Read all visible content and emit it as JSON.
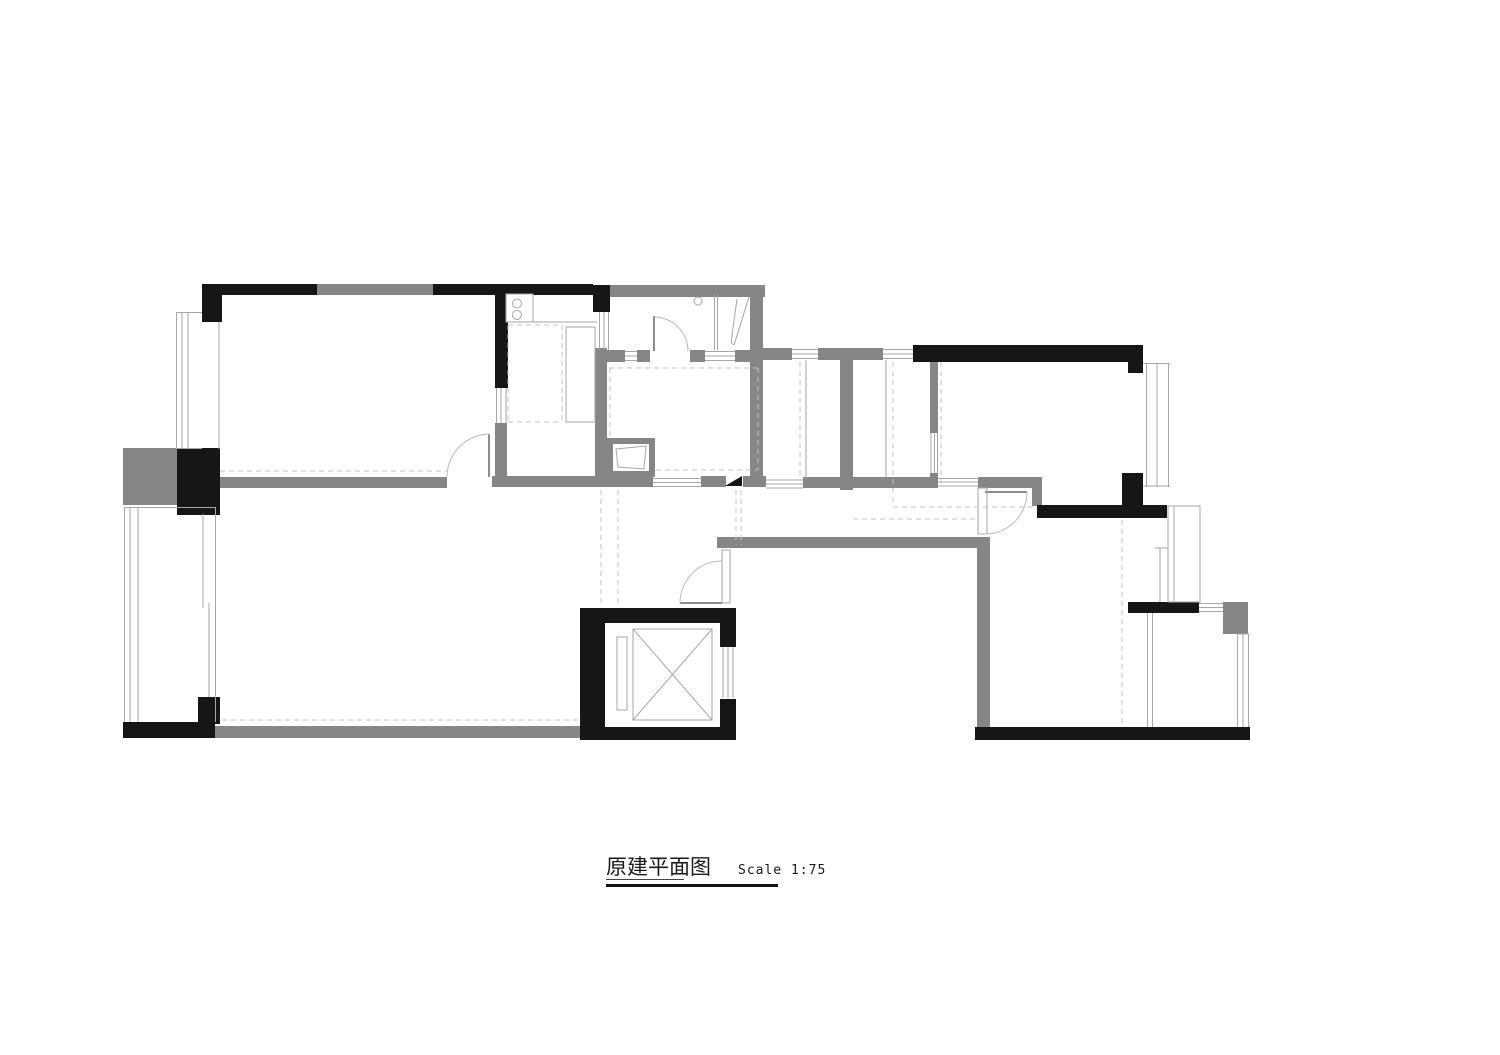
{
  "title": {
    "main": "原建平面图",
    "scale": "Scale 1:75"
  },
  "colors": {
    "wall_black": "#161616",
    "wall_gray": "#868686",
    "thin": "#a6a6a6",
    "mid": "#8c8c8c",
    "dash": "#c3c3c3",
    "arc": "#b9b9b9",
    "white": "#ffffff"
  },
  "plan": {
    "gray_rects": [
      [
        317,
        284,
        116,
        11,
        "wall-top-window-segment"
      ],
      [
        605,
        285,
        160,
        12,
        "bath-north-wall"
      ],
      [
        750,
        297,
        13,
        180,
        "bath-east-wall"
      ],
      [
        220,
        477,
        227,
        11,
        "bedroom1-south-wall"
      ],
      [
        492,
        476,
        161,
        11,
        "kitchen-south-wall"
      ],
      [
        495,
        423,
        12,
        53,
        "kitchen-west-gray"
      ],
      [
        595,
        348,
        12,
        129,
        "kitchen-east-wall"
      ],
      [
        605,
        350,
        20,
        12,
        "bath-divider-a"
      ],
      [
        637,
        350,
        13,
        12,
        "bath-divider-b"
      ],
      [
        690,
        350,
        15,
        12,
        "bath-divider-c"
      ],
      [
        735,
        350,
        28,
        12,
        "bath-divider-d"
      ],
      [
        763,
        348,
        29,
        12,
        "shaft-north-a"
      ],
      [
        818,
        348,
        65,
        12,
        "shaft-north-b"
      ],
      [
        840,
        360,
        13,
        130,
        "shaft-divider-wall"
      ],
      [
        930,
        362,
        8,
        71,
        "bedroom2-west-wall"
      ],
      [
        930,
        473,
        8,
        15,
        "bedroom2-west-foot"
      ],
      [
        701,
        476,
        25,
        11,
        "bath-south-b"
      ],
      [
        743,
        476,
        23,
        11,
        "bath-south-c"
      ],
      [
        803,
        477,
        135,
        11,
        "shaft-south-wall"
      ],
      [
        978,
        477,
        64,
        11,
        "hall-north-wall"
      ],
      [
        1032,
        477,
        10,
        29,
        "hall-jamb-wall"
      ],
      [
        717,
        537,
        273,
        11,
        "hall-south-wall"
      ],
      [
        977,
        548,
        13,
        179,
        "bedroom3-west-wall"
      ],
      [
        215,
        726,
        365,
        12,
        "living-south-wall"
      ],
      [
        123,
        448,
        54,
        57,
        "west-gray-block"
      ],
      [
        1223,
        602,
        25,
        32,
        "balcony2-gray-block"
      ],
      [
        607,
        438,
        48,
        6,
        "basin-box-top"
      ],
      [
        607,
        438,
        6,
        39,
        "basin-box-left"
      ],
      [
        649,
        438,
        6,
        39,
        "basin-box-right"
      ],
      [
        607,
        471,
        48,
        6,
        "basin-box-bottom"
      ]
    ],
    "black_rects": [
      [
        202,
        284,
        20,
        38,
        "column-topleft"
      ],
      [
        202,
        284,
        115,
        11,
        "top-wall-west"
      ],
      [
        433,
        284,
        160,
        11,
        "top-wall-east"
      ],
      [
        495,
        295,
        13,
        93,
        "kitchen-west-wall"
      ],
      [
        593,
        285,
        17,
        27,
        "column-bath-north"
      ],
      [
        913,
        345,
        230,
        17,
        "bedroom2-north-wall"
      ],
      [
        1128,
        345,
        15,
        28,
        "column-northeast"
      ],
      [
        1122,
        473,
        21,
        32,
        "column-bedroom2-se"
      ],
      [
        1037,
        505,
        130,
        13,
        "bedroom2-south-wall"
      ],
      [
        177,
        448,
        43,
        67,
        "column-west-mid"
      ],
      [
        198,
        697,
        22,
        27,
        "corner-stub-southwest"
      ],
      [
        123,
        722,
        92,
        16,
        "southwest-wall"
      ],
      [
        1128,
        602,
        71,
        11,
        "balcony2-north-wall"
      ],
      [
        975,
        727,
        275,
        13,
        "southeast-wall"
      ],
      [
        580,
        608,
        156,
        132,
        "elevator-shaft-frame"
      ]
    ],
    "white_rects": [
      [
        605,
        623,
        115,
        104,
        "elevator-cab-interior"
      ],
      [
        718,
        647,
        18,
        52,
        "elevator-door-opening"
      ],
      [
        613,
        444,
        36,
        27,
        "basin-box-interior"
      ]
    ],
    "outline_rects": [
      [
        633,
        629,
        79,
        91,
        "none",
        "elevator-car-box"
      ],
      [
        617,
        637,
        10,
        73,
        "none",
        "elevator-counterweight"
      ],
      [
        978,
        488,
        9,
        46,
        "#ffffff",
        "bedroom3-door-frame"
      ],
      [
        722,
        550,
        8,
        53,
        "#ffffff",
        "entry-door-frame"
      ],
      [
        506,
        294,
        27,
        28,
        "#ffffff",
        "stove-unit"
      ],
      [
        566,
        327,
        29,
        95,
        "#ffffff",
        "kitchen-cabinet"
      ],
      [
        1168,
        506,
        32,
        96,
        "#ffffff",
        "ac-platform"
      ]
    ],
    "thin_lines": [
      [
        653,
        478.5,
        701,
        478.5,
        "window-bath-s-1"
      ],
      [
        653,
        482.5,
        701,
        482.5,
        "window-bath-s-2"
      ],
      [
        653,
        486.5,
        701,
        486.5,
        "window-bath-s-3"
      ],
      [
        766,
        480,
        803,
        480,
        "window-shaft-s-1"
      ],
      [
        766,
        484,
        803,
        484,
        "window-shaft-s-2"
      ],
      [
        766,
        488,
        803,
        488,
        "window-shaft-s-3"
      ],
      [
        938,
        478.5,
        978,
        478.5,
        "opening-bedroom2-1"
      ],
      [
        938,
        482,
        978,
        482,
        "opening-bedroom2-2"
      ],
      [
        938,
        486,
        978,
        486,
        "opening-bedroom2-3"
      ],
      [
        792,
        349.5,
        818,
        349.5,
        "window-shaft-n1-1"
      ],
      [
        792,
        354,
        818,
        354,
        "window-shaft-n1-2"
      ],
      [
        792,
        358.5,
        818,
        358.5,
        "window-shaft-n1-3"
      ],
      [
        883,
        349.5,
        913,
        349.5,
        "window-shaft-n2-1"
      ],
      [
        883,
        354,
        913,
        354,
        "window-shaft-n2-2"
      ],
      [
        883,
        358.5,
        913,
        358.5,
        "window-shaft-n2-3"
      ],
      [
        625,
        351.5,
        637,
        351.5,
        "window-bathdiv-1"
      ],
      [
        625,
        356,
        637,
        356,
        "window-bathdiv-2"
      ],
      [
        625,
        360.5,
        637,
        360.5,
        "window-bathdiv-3"
      ],
      [
        705,
        351.5,
        735,
        351.5,
        "window-bathdiv-4"
      ],
      [
        705,
        356,
        735,
        356,
        "window-bathdiv-5"
      ],
      [
        705,
        360.5,
        735,
        360.5,
        "window-bathdiv-6"
      ],
      [
        496.5,
        388,
        496.5,
        423,
        "window-kitchen-w-1"
      ],
      [
        501,
        388,
        501,
        423,
        "window-kitchen-w-2"
      ],
      [
        506,
        388,
        506,
        423,
        "window-kitchen-w-3"
      ],
      [
        599.5,
        312,
        599.5,
        350,
        "window-bath-w-1"
      ],
      [
        604,
        312,
        604,
        350,
        "window-bath-w-2"
      ],
      [
        608.5,
        312,
        608.5,
        350,
        "window-bath-w-3"
      ],
      [
        931,
        433,
        931,
        473,
        "window-bedroom2-w-1"
      ],
      [
        934.5,
        433,
        934.5,
        473,
        "window-bedroom2-w-2"
      ],
      [
        937.5,
        433,
        937.5,
        473,
        "window-bedroom2-w-3"
      ],
      [
        176.5,
        312,
        176.5,
        449,
        "baywindow-w-1"
      ],
      [
        182,
        312,
        182,
        449,
        "baywindow-w-2"
      ],
      [
        188,
        312,
        188,
        449,
        "baywindow-w-3"
      ],
      [
        176,
        312.5,
        202,
        312.5,
        "baywindow-w-top"
      ],
      [
        176,
        448.5,
        202,
        448.5,
        "baywindow-w-bottom"
      ],
      [
        219,
        322,
        219,
        449,
        "bedroom1-west-face"
      ],
      [
        1146.5,
        363,
        1146.5,
        487,
        "baywindow-e-1"
      ],
      [
        1157,
        363,
        1157,
        487,
        "baywindow-e-2"
      ],
      [
        1168.5,
        363,
        1168.5,
        487,
        "baywindow-e-3"
      ],
      [
        1143,
        363.5,
        1170,
        363.5,
        "baywindow-e-top"
      ],
      [
        1143,
        486,
        1170,
        486,
        "baywindow-e-bottom"
      ],
      [
        124.5,
        507,
        124.5,
        722,
        "balcony1-wall-1"
      ],
      [
        130,
        507,
        130,
        722,
        "balcony1-wall-2"
      ],
      [
        138,
        507,
        138,
        722,
        "balcony1-wall-3"
      ],
      [
        124,
        507.5,
        215,
        507.5,
        "balcony1-top"
      ],
      [
        215.5,
        507,
        215.5,
        722,
        "balcony1-inner-face"
      ],
      [
        203,
        514,
        203,
        608,
        "balcony1-slider-a"
      ],
      [
        209,
        603,
        209,
        697,
        "balcony1-slider-b"
      ],
      [
        1147.5,
        613,
        1147.5,
        727,
        "balcony2-slider-a"
      ],
      [
        1152.5,
        613,
        1152.5,
        727,
        "balcony2-slider-b"
      ],
      [
        1199,
        603.5,
        1223,
        603.5,
        "balcony2-window-n-1"
      ],
      [
        1199,
        607.5,
        1223,
        607.5,
        "balcony2-window-n-2"
      ],
      [
        1199,
        611.5,
        1223,
        611.5,
        "balcony2-window-n-3"
      ],
      [
        1237.5,
        634,
        1237.5,
        727,
        "balcony2-window-e-1"
      ],
      [
        1243,
        634,
        1243,
        727,
        "balcony2-window-e-2"
      ],
      [
        1248.5,
        634,
        1248.5,
        727,
        "balcony2-window-e-3"
      ],
      [
        1237,
        634,
        1249,
        634,
        "balcony2-window-e-top"
      ],
      [
        723,
        647,
        723,
        698,
        "elevator-door-1"
      ],
      [
        728,
        647,
        728,
        698,
        "elevator-door-2"
      ],
      [
        733,
        647,
        733,
        698,
        "elevator-door-3"
      ],
      [
        633,
        629,
        712,
        720,
        "elevator-x-diag-1"
      ],
      [
        633,
        720,
        712,
        629,
        "elevator-x-diag-2"
      ],
      [
        806,
        360,
        806,
        479,
        "shaft1-glass-line"
      ],
      [
        886,
        360,
        886,
        477,
        "shaft2-glass-line"
      ],
      [
        1174,
        506,
        1174,
        602,
        "ac-platform-inner"
      ],
      [
        1160,
        548,
        1160,
        602,
        "ac-platform-side"
      ],
      [
        1155,
        548,
        1168,
        548,
        "ac-platform-side-top"
      ],
      [
        737,
        299,
        731,
        343,
        "shower-screen-1"
      ],
      [
        749,
        297,
        734,
        345,
        "shower-screen-2"
      ],
      [
        731,
        343,
        734,
        345,
        "shower-screen-base"
      ],
      [
        714.5,
        295,
        714.5,
        350,
        "bath-partition-1"
      ],
      [
        717.5,
        295,
        717.5,
        350,
        "bath-partition-2"
      ],
      [
        508,
        322,
        597,
        322,
        "kitchen-counter-edge"
      ]
    ],
    "mid_lines": [
      [
        489,
        434,
        489,
        477,
        "door-leaf-bedroom1"
      ],
      [
        654,
        316,
        654,
        351,
        "door-leaf-bath"
      ],
      [
        985,
        492,
        1027,
        492,
        "door-leaf-bedroom3"
      ],
      [
        680,
        603,
        722,
        603,
        "door-leaf-entry"
      ]
    ],
    "dashed_lines": [
      [
        220,
        471,
        447,
        471,
        "curtain-bedroom1"
      ],
      [
        222,
        720,
        578,
        720,
        "curtain-living"
      ],
      [
        609,
        368,
        758,
        368,
        "bath-ceiling-top"
      ],
      [
        610,
        368,
        610,
        440,
        "bath-ceiling-left"
      ],
      [
        758,
        368,
        758,
        470,
        "bath-ceiling-right"
      ],
      [
        656,
        470,
        758,
        470,
        "bath-ceiling-bottom"
      ],
      [
        601,
        490,
        601,
        606,
        "foyer-beam-1"
      ],
      [
        618,
        490,
        618,
        606,
        "foyer-beam-2"
      ],
      [
        736,
        490,
        736,
        545,
        "foyer-beam-3"
      ],
      [
        741,
        490,
        741,
        545,
        "foyer-beam-4"
      ],
      [
        800,
        362,
        800,
        477,
        "shaft1-dash"
      ],
      [
        893,
        362,
        893,
        505,
        "shaft2-dash"
      ],
      [
        893,
        507,
        1035,
        507,
        "bulkhead-h1"
      ],
      [
        853,
        519,
        978,
        519,
        "bulkhead-h2"
      ],
      [
        941,
        362,
        941,
        487,
        "bedroom2-dash"
      ],
      [
        1122,
        520,
        1122,
        727,
        "bedroom3-dash"
      ],
      [
        508,
        325,
        562,
        325,
        "counter-dash-top"
      ],
      [
        562,
        325,
        562,
        422,
        "counter-dash-right"
      ],
      [
        508,
        422,
        562,
        422,
        "counter-dash-bottom"
      ],
      [
        508,
        325,
        508,
        422,
        "counter-dash-left"
      ]
    ],
    "arcs": [
      [
        490,
        477,
        43,
        180,
        270,
        "door-arc-bedroom1"
      ],
      [
        654,
        351,
        34,
        270,
        360,
        "door-arc-bath"
      ],
      [
        985,
        492,
        42,
        0,
        90,
        "door-arc-bedroom3"
      ],
      [
        722,
        603,
        42,
        180,
        270,
        "door-arc-entry"
      ]
    ],
    "circles": [
      [
        517,
        303.5,
        4.5,
        "stove-burner-1"
      ],
      [
        517,
        315,
        4.5,
        "stove-burner-2"
      ],
      [
        698,
        301,
        4,
        "floor-drain"
      ]
    ],
    "polygons": [
      {
        "pts": [
          [
            725,
            486
          ],
          [
            742,
            486
          ],
          [
            742,
            476
          ]
        ],
        "fill": "#161616",
        "stroke": "none",
        "name": "threshold-marker"
      },
      {
        "pts": [
          [
            616,
            449
          ],
          [
            646,
            446
          ],
          [
            644,
            469
          ],
          [
            618,
            467
          ]
        ],
        "fill": "none",
        "stroke": "#a6a6a6",
        "name": "wash-basin"
      }
    ]
  }
}
